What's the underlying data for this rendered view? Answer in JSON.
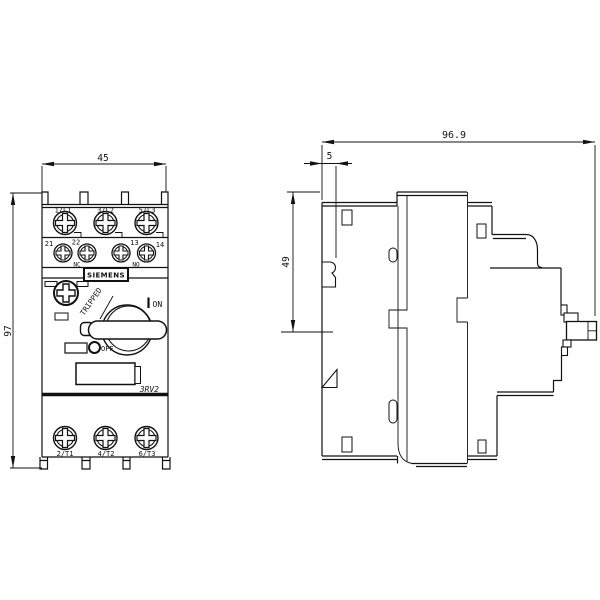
{
  "front_view": {
    "dim_width": "45",
    "dim_height": "97",
    "line_terminals": [
      "1/L1",
      "3/L2",
      "5/L3"
    ],
    "aux_terminals": [
      "21",
      "22",
      "13",
      "14"
    ],
    "aux_contacts": [
      "NC",
      "NO"
    ],
    "brand": "SIEMENS",
    "tripped_label": "TRIPPED",
    "on_label": "ON",
    "off_label": "OFF",
    "series_label": "3RV2",
    "load_terminals": [
      "2/T1",
      "4/T2",
      "6/T3"
    ]
  },
  "side_view": {
    "dim_depth": "96.9",
    "dim_offset": "5",
    "dim_height": "49"
  }
}
